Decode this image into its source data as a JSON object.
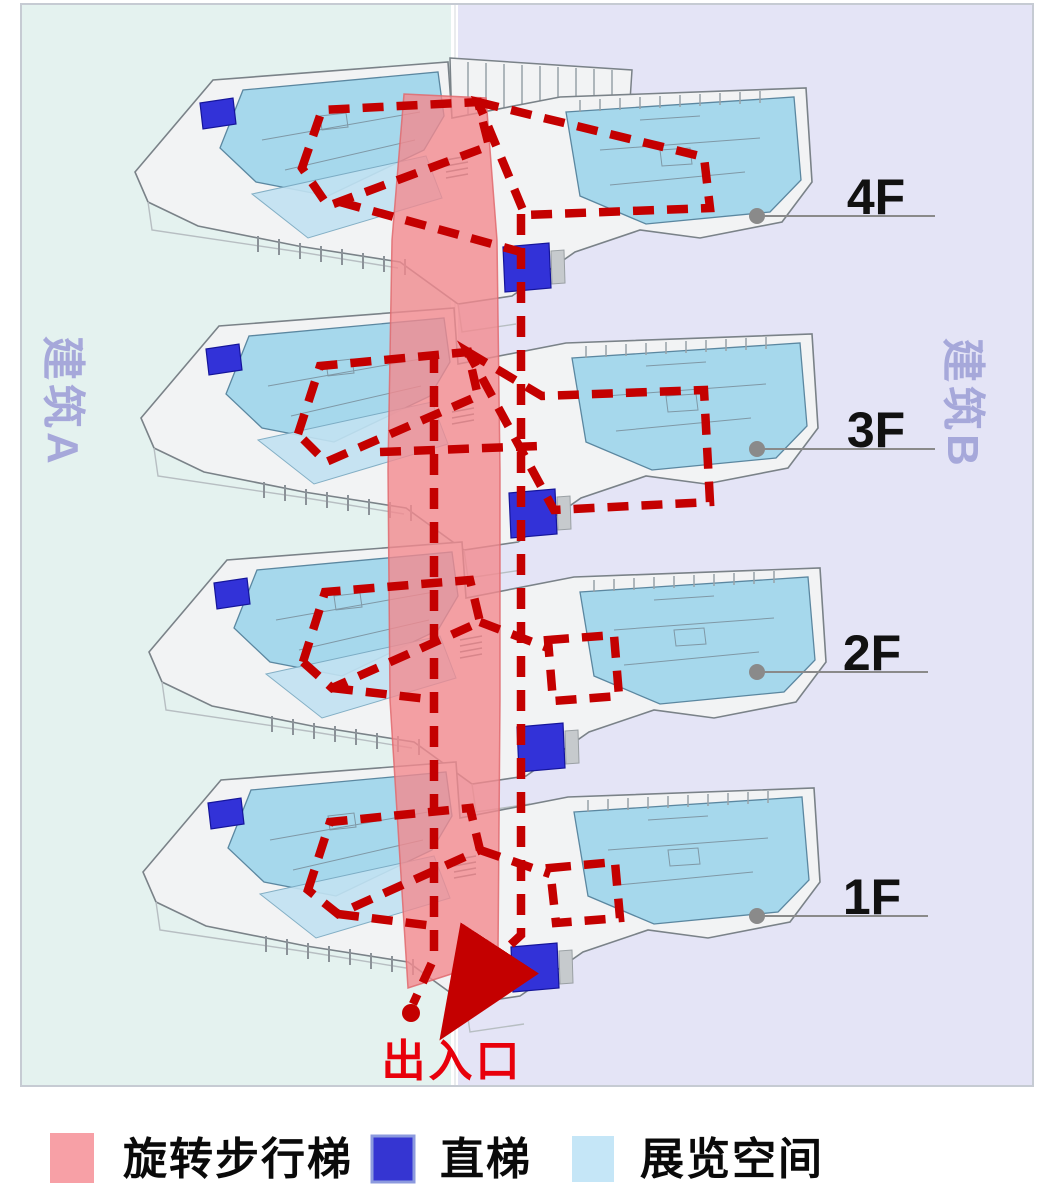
{
  "buildings": {
    "a": {
      "label": "建筑A"
    },
    "b": {
      "label": "建筑B"
    }
  },
  "floors": [
    {
      "label": "4F"
    },
    {
      "label": "3F"
    },
    {
      "label": "2F"
    },
    {
      "label": "1F"
    }
  ],
  "entrance": {
    "label": "出入口"
  },
  "legend": {
    "items": [
      {
        "label": "旋转步行梯",
        "color": "#f7a0a6"
      },
      {
        "label": "直梯",
        "color": "#3535d2",
        "border_color": "#8c9ade"
      },
      {
        "label": "展览空间",
        "color": "#c5e6f7"
      }
    ]
  },
  "colors": {
    "building_a_bg": "#e4f2ef",
    "building_b_bg": "#e4e4f6",
    "panel_border": "#c6cbd3",
    "slab": "#f2f3f4",
    "slab_stroke": "#7a8288",
    "exhibition": "#a6d8ec",
    "exhibition_light": "#c2e2f2",
    "elevator": "#3232d8",
    "spiral_stair": "#f28a8e",
    "route": "#c40000",
    "leader": "#8a8a8a",
    "floor_label": "#111111",
    "building_label": "#a6a8da",
    "entrance_label": "#e8000b"
  }
}
